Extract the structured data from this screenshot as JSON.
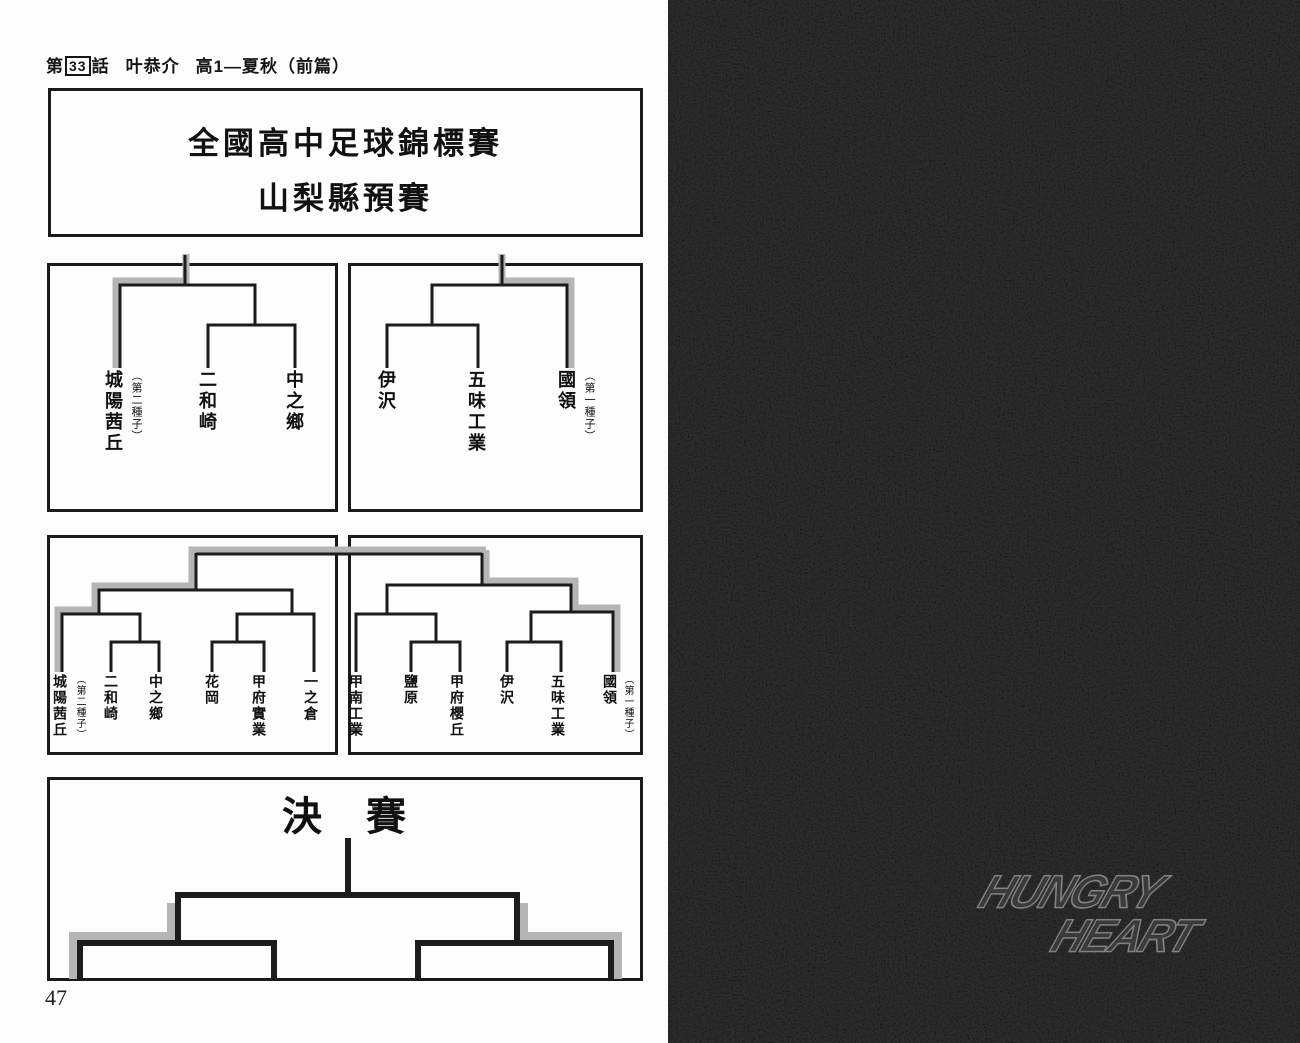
{
  "header": {
    "chapter_prefix": "第",
    "chapter_number": "33",
    "chapter_suffix": "話",
    "character_name": "叶恭介",
    "episode_title": "高1—夏秋（前篇）"
  },
  "tournament": {
    "title_line1": "全國高中足球錦標賽",
    "title_line2": "山梨縣預賽",
    "final_label": "決　賽",
    "block_a": {
      "teams": [
        {
          "name": "城陽茜丘",
          "seed": "（第二種子）"
        },
        {
          "name": "二和崎"
        },
        {
          "name": "中之鄉"
        }
      ]
    },
    "block_b": {
      "teams": [
        {
          "name": "伊沢"
        },
        {
          "name": "五味工業"
        },
        {
          "name": "國領",
          "seed": "（第一種子）"
        }
      ]
    },
    "left_half": {
      "teams": [
        {
          "name": "城陽茜丘",
          "seed": "（第二種子）"
        },
        {
          "name": "二和崎"
        },
        {
          "name": "中之鄉"
        },
        {
          "name": "花岡"
        },
        {
          "name": "甲府實業"
        },
        {
          "name": "一之倉"
        }
      ]
    },
    "right_half": {
      "teams": [
        {
          "name": "甲南工業"
        },
        {
          "name": "鹽原"
        },
        {
          "name": "甲府櫻丘"
        },
        {
          "name": "伊沢"
        },
        {
          "name": "五味工業"
        },
        {
          "name": "國領",
          "seed": "（第一種子）"
        }
      ]
    }
  },
  "page_number": "47",
  "logo": {
    "word1": "HUNGRY",
    "word2": "HEART",
    "badges": [
      "野",
      "獸",
      "射",
      "手"
    ]
  },
  "colors": {
    "ink": "#1c1c1c",
    "highlight": "#b5b5b5",
    "dark_page": "#2b2b2b"
  }
}
